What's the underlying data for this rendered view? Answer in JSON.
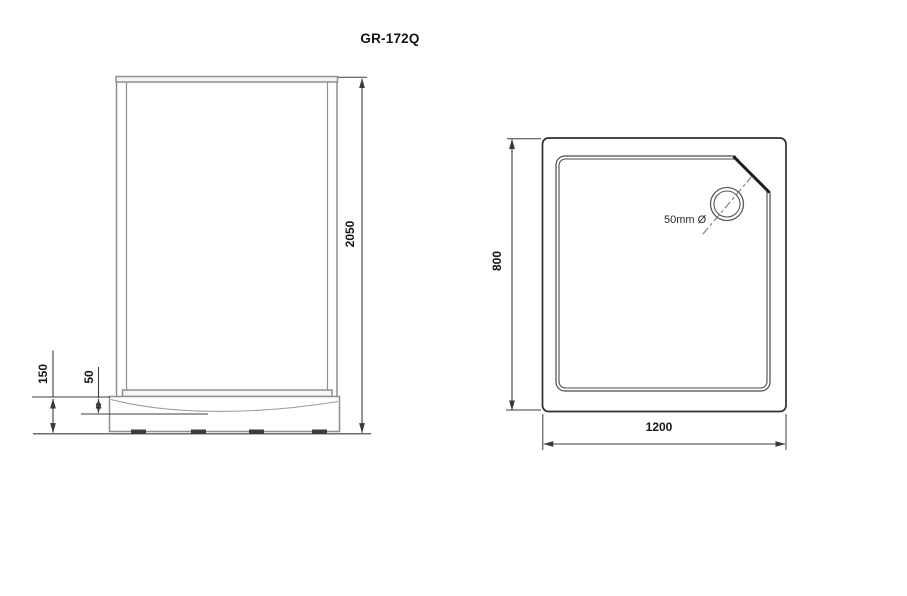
{
  "title": "GR-172Q",
  "front_view": {
    "overall_height_mm": "2050",
    "base_height_mm": "150",
    "tray_depth_mm": "50"
  },
  "plan_view": {
    "depth_mm": "800",
    "width_mm": "1200",
    "drain_diameter_label": "50mm Ø"
  },
  "colors": {
    "frame_line": "#8f8f8f",
    "tray_curve_line": "#9b9b9b",
    "plan_outline": "#2e2e2e",
    "plan_inner_line": "#4a4a4a",
    "chamfer_line": "#1c1c1c",
    "dimension_line": "#3c3c3c",
    "feet_fill": "#3d3d3d",
    "text": "#141414",
    "background": "#ffffff"
  }
}
